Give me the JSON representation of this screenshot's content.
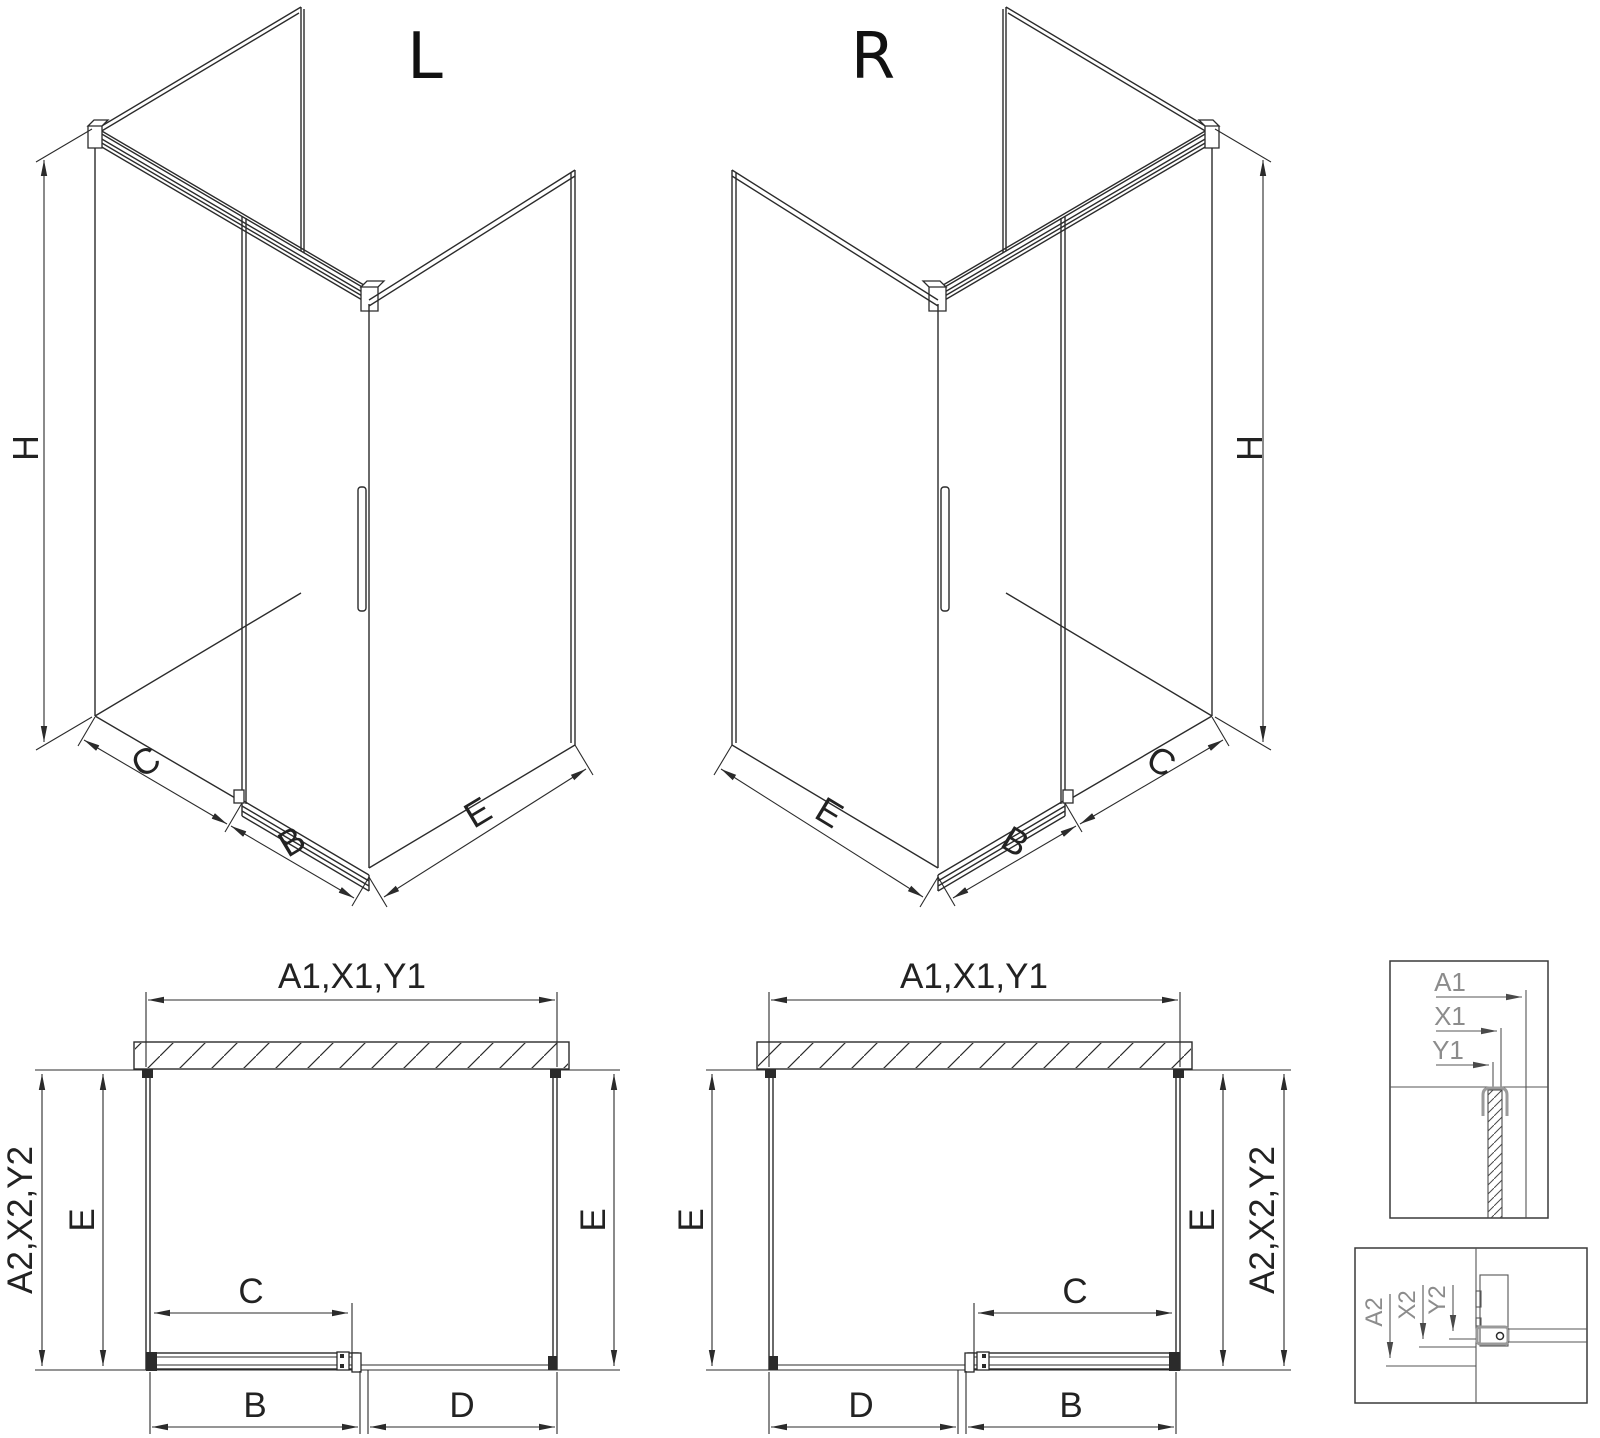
{
  "drawing": {
    "description": "Shower enclosure technical installation drawing, left and right variants",
    "variant_left_title": "L",
    "variant_right_title": "R",
    "iso_labels": {
      "height": "H",
      "fixed_segment": "C",
      "door_segment": "B",
      "side_panel": "E"
    },
    "plan_labels": {
      "top_width": "A1,X1,Y1",
      "side_depth": "A2,X2,Y2",
      "depth": "E",
      "door_travel": "C",
      "door_width": "B",
      "fixed_width": "D"
    },
    "detail_top_labels": {
      "a1": "A1",
      "x1": "X1",
      "y1": "Y1"
    },
    "detail_bottom_labels": {
      "a2": "A2",
      "x2": "X2",
      "y2": "Y2"
    },
    "colors": {
      "line": "#2b2b2b",
      "detail_gray": "#8c8c8c",
      "background": "#ffffff"
    }
  }
}
